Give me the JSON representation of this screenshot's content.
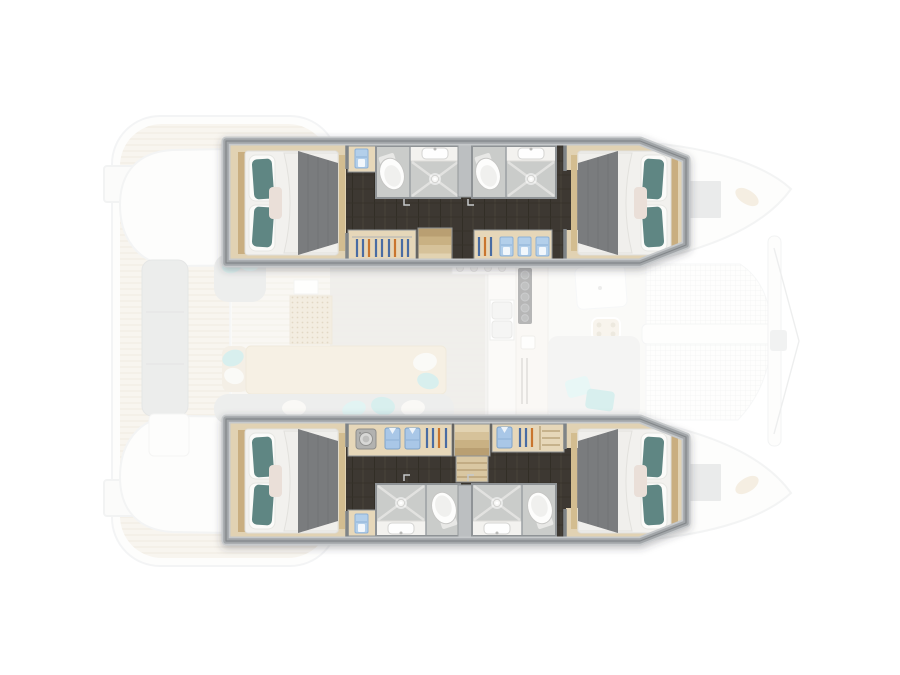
{
  "meta": {
    "description": "Catamaran yacht interior floor plan, top-down view, bow pointing right. Four highlighted double cabins with ensuite bathrooms in the two hulls; saloon, galley, cockpit, swim platforms and bow trampoline shown faded.",
    "view": "top-down floor plan",
    "bow_direction": "right",
    "highlighted_layout": "4 double cabins + 4 ensuite bathrooms"
  },
  "palette": {
    "background": "#ffffff",
    "wall_gray": "#a2a6a9",
    "wall_edge_dark": "#83878a",
    "cabin_floor_wood": "#e1d2b3",
    "corridor_wood_dark": "#3e3830",
    "bathroom_floor": "#caccca",
    "pillow_teal": "#5f8683",
    "pillow_pink": "#eadfd8",
    "blanket_gray": "#7a7b7e",
    "mattress_white": "#f2f1ee",
    "towel_blue": "#b3cfea",
    "shirt_blue": "#a9c7e7",
    "hanger_blue": "#4a6ca3",
    "hanger_orange": "#c9742e",
    "stair_wood_dark": "#b99f72",
    "stair_wood_light": "#e2d3b2",
    "teak_deck": "#f0eadd",
    "faded_furniture_gray": "#d8dad8",
    "accent_aqua_faded": "#a9dddb",
    "cooktop_dark": "#5e5f60",
    "trampoline_net": "#e8eaea"
  },
  "boat": {
    "port_hull": {
      "position": "top",
      "rooms": [
        "aft-double-cabin",
        "aft-ensuite-bathroom",
        "forward-ensuite-bathroom",
        "wardrobe-lockers",
        "companionway-stairs",
        "forward-double-cabin"
      ]
    },
    "starboard_hull": {
      "position": "bottom",
      "rooms": [
        "aft-double-cabin",
        "laundry-wardrobe-locker",
        "companionway-stairs",
        "aft-ensuite-bathroom",
        "forward-ensuite-bathroom",
        "forward-double-cabin"
      ]
    },
    "faded_areas": [
      "aft-swim-platforms",
      "aft-cockpit-bench",
      "saloon-seating",
      "saloon-table-daybed",
      "galley-counters",
      "foredeck-lounge",
      "bow-trampoline",
      "bow-crossbeam",
      "deck-hatches"
    ]
  },
  "icons": [
    "washing-machine-icon",
    "clothes-hanger-icon",
    "folded-towel-icon",
    "folded-shirt-icon",
    "toilet-icon",
    "washbasin-icon",
    "shower-drain-icon",
    "cooktop-burners-icon",
    "double-sink-icon",
    "bed-icon"
  ]
}
